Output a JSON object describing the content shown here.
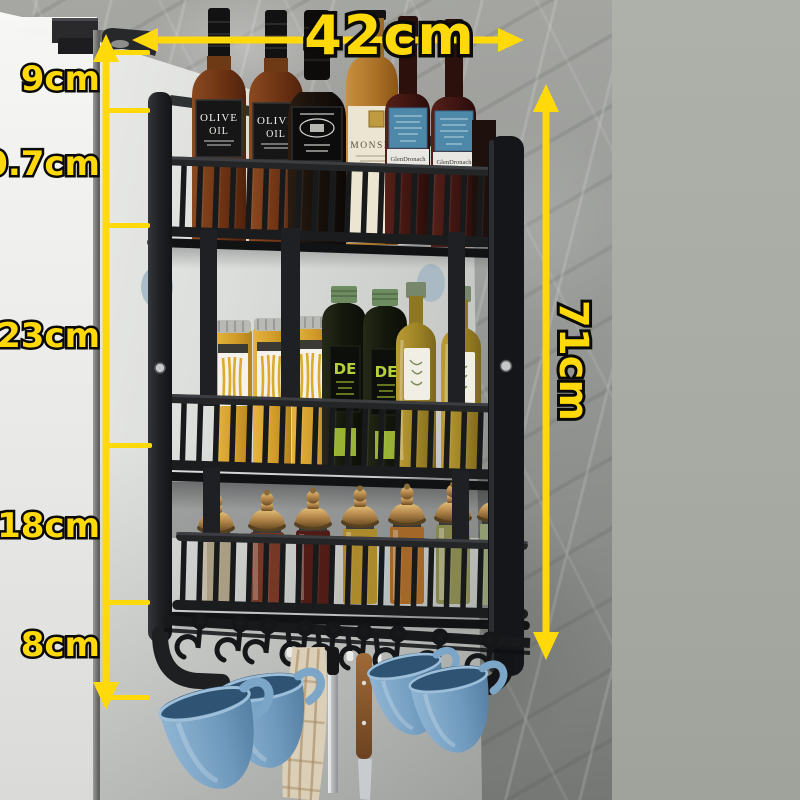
{
  "image_type": "e-commerce product photo with dimension callouts",
  "product": {
    "name": "3-tier black metal fridge-side hanging spice rack with hooks",
    "mounted_on": "refrigerator side panel",
    "background": "gray marble wall"
  },
  "dimensions": {
    "arrow_color": "#ffd90a",
    "top_width": "42cm",
    "left_segments": [
      "9cm",
      "10.7cm",
      "23cm",
      "18cm",
      "8cm"
    ],
    "total_height": "71cm"
  },
  "bottle_labels": {
    "olive_oil_line1": "OLIVE",
    "olive_oil_line2": "OIL",
    "monsie": "MONSIE",
    "glendronach": "GlenDronach",
    "de": "DE"
  },
  "shelf_contents": {
    "top": "olive oil and whisky bottles",
    "middle": "pasta jars and olive oil bottles",
    "bottom": "spice jars with brass lids",
    "hooks": "blue mugs, plaid towel, knives"
  }
}
